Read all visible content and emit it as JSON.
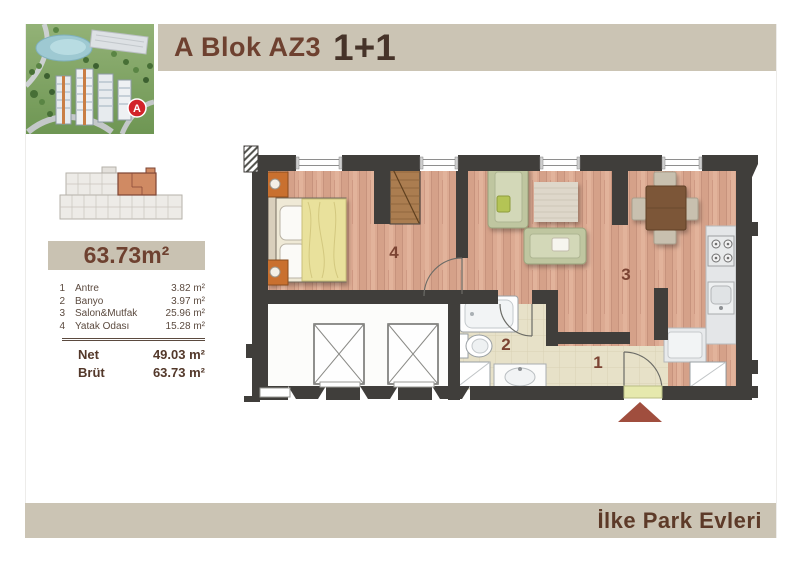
{
  "header": {
    "block_title": "A Blok AZ3",
    "unit_type": "1+1"
  },
  "area_box": {
    "total": "63.73m²"
  },
  "rooms": {
    "title_rows": [
      {
        "no": "1",
        "name": "Antre",
        "area": "3.82 m²"
      },
      {
        "no": "2",
        "name": "Banyo",
        "area": "3.97 m²"
      },
      {
        "no": "3",
        "name": "Salon&Mutfak",
        "area": "25.96 m²"
      },
      {
        "no": "4",
        "name": "Yatak Odası",
        "area": "15.28 m²"
      }
    ],
    "totals": [
      {
        "label": "Net",
        "value": "49.03 m²"
      },
      {
        "label": "Brüt",
        "value": "63.73 m²"
      }
    ]
  },
  "plan": {
    "labels": {
      "entry": "1",
      "bath": "2",
      "living": "3",
      "bedroom": "4"
    }
  },
  "photo": {
    "marker": "A"
  },
  "footer": {
    "brand": "İlke Park Evleri"
  },
  "colors": {
    "band": "#cbc4b4",
    "title_accent": "#6e4130",
    "title_dark": "#463329",
    "wall": "#403e3b",
    "wood_floor": "#d9a78f",
    "entry_tile": "#e6e0c5",
    "keyplan_highlight": "#d08a63",
    "entrance_arrow": "#a04e3e",
    "marker_red": "#d2232a"
  }
}
